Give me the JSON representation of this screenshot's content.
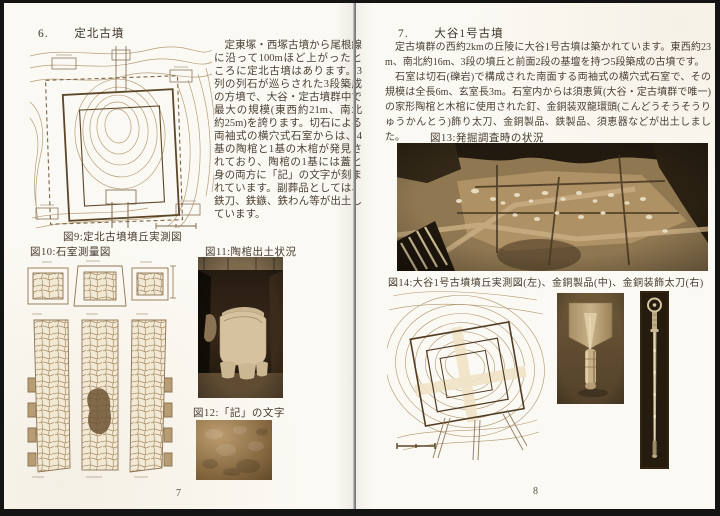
{
  "left_page": {
    "page_number": "7",
    "section_number": "6.",
    "section_title": "定北古墳",
    "body": "定東塚・西塚古墳から尾根線に沿って100mほど上がったところに定北古墳はあります。3列の列石が巡らされた3段築成の方墳で、大谷・定古墳群中で最大の規模(東西約21m、南北約25m)を誇ります。切石による両袖式の横穴式石室からは、4基の陶棺と1基の木棺が発見されており、陶棺の1基には蓋と身の両方に「記」の文字が刻まれています。副葬品としては、鉄刀、鉄鏃、鉄わん等が出土しています。",
    "fig9_caption": "図9:定北古墳墳丘実測図",
    "fig10_caption": "図10:石室測量図",
    "fig11_caption": "図11:陶棺出土状況",
    "fig12_caption": "図12:「記」の文字"
  },
  "right_page": {
    "page_number": "8",
    "section_number": "7.",
    "section_title": "大谷1号古墳",
    "para1": "定古墳群の西約2kmの丘陵に大谷1号古墳は築かれています。東西約23m、南北約16m、3段の墳丘と前面2段の基壇を持つ5段築成の古墳です。",
    "para2": "石室は切石(礫岩)で構成された南面する両袖式の横穴式石室で、その規模は全長6m、玄室長3m。石室内からは須恵質(大谷・定古墳群で唯一)の家形陶棺と木棺に使用された釘、金銅装双龍環頭(こんどうそうそうりゅうかんとう)飾り太刀、金銅製品、鉄製品、須恵器などが出土しました。",
    "fig13_caption": "図13:発掘調査時の状況",
    "fig14_caption": "図14:大谷1号古墳墳丘実測図(左)、金銅製品(中)、金銅装飾太刀(右)"
  },
  "colors": {
    "page_background": "#fbf9f3",
    "ink": "#463d31",
    "line_art_sepia": "#9c8260",
    "photo_dark_brown": "#2a1f12",
    "photo_mid_brown": "#8a7049",
    "photo_highlight": "#d9c7a2",
    "frame_black": "#141414",
    "gutter_gray": "#8f8f8f"
  }
}
